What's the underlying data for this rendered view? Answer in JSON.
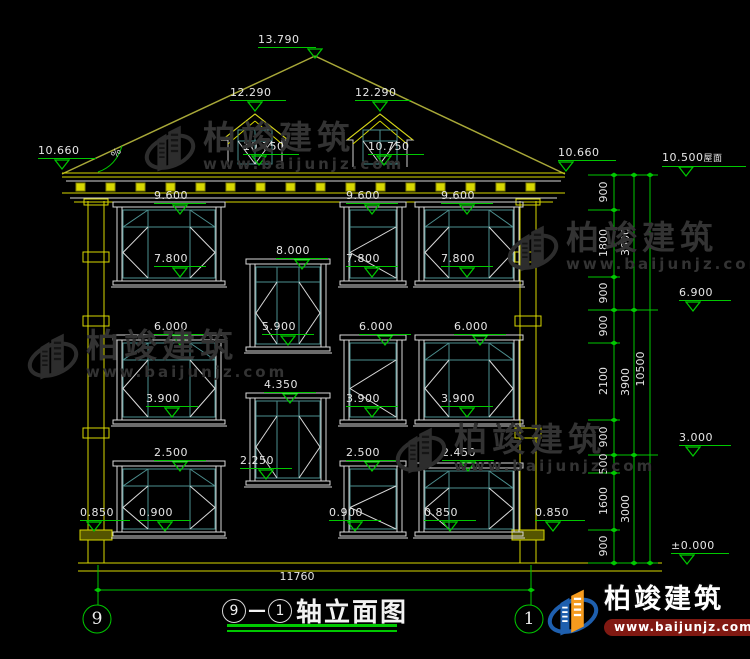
{
  "drawing": {
    "axis_left": "9",
    "axis_right": "1",
    "title_axis_start": "9",
    "title_dash": "—",
    "title_axis_end": "1",
    "title_text": "轴立面图"
  },
  "labels": {
    "ridge": "13.790",
    "dormer_l": "12.290",
    "dormer_r": "12.290",
    "dormer_sill_l": "10.750",
    "dormer_sill_r": "10.750",
    "eave_l": "10.660",
    "eave_r": "10.660",
    "roof": "10.500",
    "roof_suffix": "屋面",
    "slope": "%",
    "f3_top_1": "9.600",
    "f3_top_2": "9.600",
    "f3_top_3": "9.600",
    "f3_sill_1": "7.800",
    "f3_sill_2": "7.800",
    "f3_sill_3": "7.800",
    "stair1_top": "8.000",
    "stair1_sill": "5.900",
    "f2_top_1": "6.000",
    "f2_top_2": "6.000",
    "f2_top_3": "6.000",
    "f2_sill_1": "3.900",
    "f2_sill_2": "3.900",
    "f2_sill_3": "3.900",
    "stair2_top": "4.350",
    "stair2_sill": "2.250",
    "f1_top_1": "2.500",
    "f1_top_2": "2.500",
    "f1_top_3": "2.450",
    "f1_sill_1": "0.900",
    "f1_sill_2": "0.900",
    "f1_sill_3": "0.850",
    "base_l": "0.850",
    "base_r": "0.850",
    "lvl_69": "6.900",
    "lvl_30": "3.000",
    "lvl_0": "±0.000"
  },
  "dims": {
    "c1": [
      "900",
      "1800",
      "900",
      "900",
      "2100",
      "900",
      "500",
      "1600",
      "900"
    ],
    "c2": [
      "3600",
      "3900",
      "3000"
    ],
    "c3": "10500",
    "overall_width": "11760"
  },
  "watermark": {
    "brand": "柏竣建筑",
    "url": "www.baijunjz.com"
  },
  "logo": {
    "brand": "柏竣建筑",
    "url": "www.baijunjz.com"
  }
}
